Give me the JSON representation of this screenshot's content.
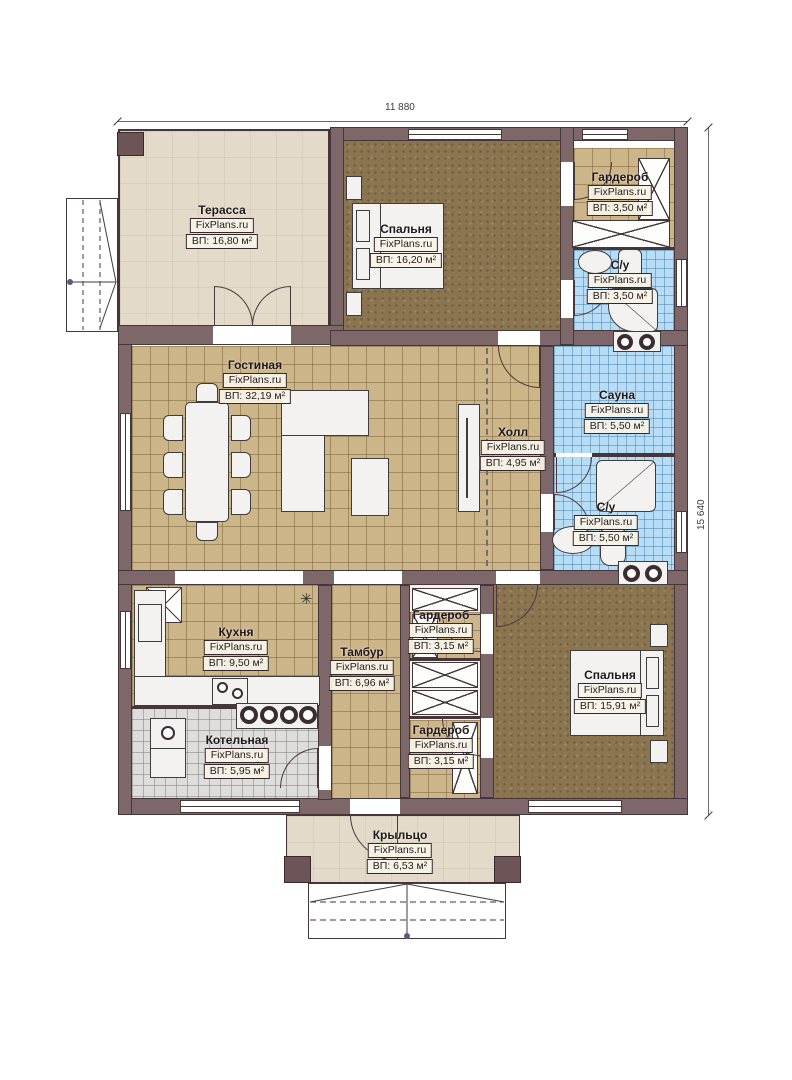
{
  "watermark": "FixPlans.ru",
  "plan": {
    "width_label": "11 880",
    "height_label": "15 640"
  },
  "symbols": {
    "lamp": "✳"
  },
  "rooms": [
    {
      "id": "terrace",
      "name": "Терасса",
      "area": "ВП: 16,80 м²"
    },
    {
      "id": "bedroom1",
      "name": "Спальня",
      "area": "ВП: 16,20 м²"
    },
    {
      "id": "wardrobe1",
      "name": "Гардероб",
      "area": "ВП: 3,50 м²"
    },
    {
      "id": "bath1",
      "name": "С/у",
      "area": "ВП: 3,50 м²"
    },
    {
      "id": "living",
      "name": "Гостиная",
      "area": "ВП: 32,19 м²"
    },
    {
      "id": "hall",
      "name": "Холл",
      "area": "ВП: 4,95 м²"
    },
    {
      "id": "sauna",
      "name": "Сауна",
      "area": "ВП: 5,50 м²"
    },
    {
      "id": "bath2",
      "name": "С/у",
      "area": "ВП: 5,50 м²"
    },
    {
      "id": "kitchen",
      "name": "Кухня",
      "area": "ВП: 9,50 м²"
    },
    {
      "id": "tambour",
      "name": "Тамбур",
      "area": "ВП: 6,96 м²"
    },
    {
      "id": "wardrobe2",
      "name": "Гардероб",
      "area": "ВП: 3,15 м²"
    },
    {
      "id": "bedroom2",
      "name": "Спальня",
      "area": "ВП: 15,91 м²"
    },
    {
      "id": "boiler",
      "name": "Котельная",
      "area": "ВП: 5,95 м²"
    },
    {
      "id": "wardrobe3",
      "name": "Гардероб",
      "area": "ВП: 3,15 м²"
    },
    {
      "id": "porch",
      "name": "Крыльцо",
      "area": "ВП: 6,53 м²"
    }
  ],
  "colors": {
    "wall": "#7d6769",
    "outline": "#453639",
    "terrace_floor": "#e3dac9",
    "wood_tile": "#cdb58a",
    "wet_tile": "#b7dcf5",
    "carpet": "#8b7550",
    "boiler_tile": "#dedddb"
  }
}
